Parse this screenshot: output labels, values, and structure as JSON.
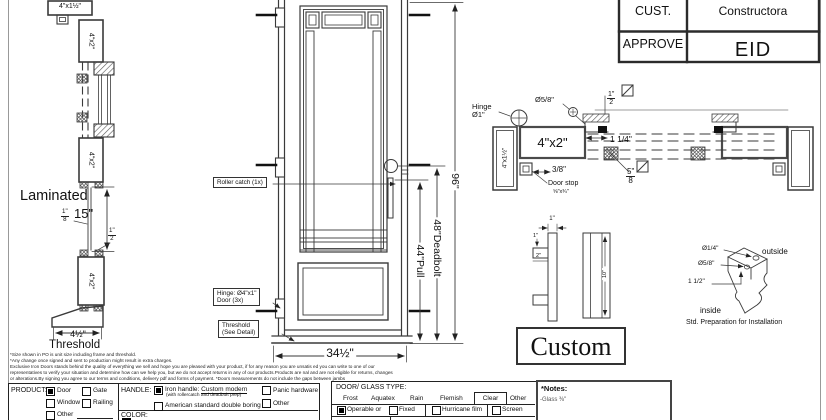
{
  "title_block": {
    "cust_label": "CUST.",
    "cust_value": "Constructora",
    "approve_label": "APPROVE",
    "approve_value": "EID"
  },
  "left_section": {
    "head_jamb": "4\"x1½\"",
    "top_rail": "4\"x2\"",
    "mid_rail": "4\"x2\"",
    "bottom_rail": "4\"x2\"",
    "laminated": "Laminated",
    "panel_thickness_num": "1\"",
    "panel_thickness_den": "8",
    "panel_height": "15\"",
    "offset_num": "1\"",
    "offset_den": "2",
    "threshold_width": "4½\"",
    "threshold_label": "Threshold"
  },
  "elevation": {
    "roller_catch": "Roller catch (1x)",
    "hinge_note_1": "Hinge: Ø4\"x1\"",
    "hinge_note_2": "Door (3x)",
    "threshold_note_1": "Threshold",
    "threshold_note_2": "(See Detail)",
    "width_dim": "34½\"",
    "pull_dim": "44\"Pull",
    "deadbolt_dim": "48\"Deadbolt",
    "height_dim": "96\""
  },
  "plan_section": {
    "hinge_label_1": "Hinge",
    "hinge_label_2": "Ø1\"",
    "pin_dia": "Ø5/8\"",
    "gap_num": "1\"",
    "gap_den": "2",
    "head_jamb": "4\"x2\"",
    "side_jamb": "4\"x1½\"",
    "stile_dim": "1 1/4\"",
    "stop_offset": "3/8\"",
    "door_stop_1": "Door stop",
    "door_stop_2": "⅝\"x¾\"",
    "glass_num": "5\"",
    "glass_den": "8"
  },
  "handle_detail": {
    "width_dim": "1\"",
    "stem_dim_1": "1\"",
    "stem_dim_2": "2\"",
    "length_dim": "10\"",
    "style_name": "Custom"
  },
  "prep_detail": {
    "hole_small": "Ø1/4\"",
    "hole_large": "Ø5/8\"",
    "spacing": "1 1/2\"",
    "outside": "outside",
    "inside": "inside",
    "caption": "Std. Preparation for Installation"
  },
  "fine_print": {
    "line1": "*Size shown in PO is unit size including frame and threshold.",
    "line2": "*Any change once signed and sent to production might result in extra charges.",
    "line3": "Exclusive Iron Doors stands behind the quality of everything we sell and hope you are pleased with your product, if for any reason you are unsatis  ed you can write to one of our",
    "line4": "representatives to verify your situation and determine how can we help you, but we do not accept returns in any of our products.Products are    nal and are not eligible for returns, changes",
    "line5": "or alterations.By signing you agree to our terms and conditions, delivery pdf and forms of payment. *Doors measurements do not include the gaps between jambs"
  },
  "form": {
    "product": {
      "label": "PRODUCT:",
      "door": "Door",
      "gate": "Gate",
      "window": "Window",
      "railing": "Railing",
      "other": "Other",
      "checked": {
        "door": true,
        "gate": false,
        "window": false,
        "railing": false,
        "other": false
      }
    },
    "handle": {
      "label": "HANDLE:",
      "iron_prefix": "Iron handle:",
      "iron_style": "Custom modern",
      "iron_sub": "(with rollercatch and deadbolt prep)",
      "american": "American standard double boring",
      "panic": "Panic hardware",
      "other": "Other",
      "checked": {
        "iron": true,
        "american": false,
        "panic": false,
        "other": false
      }
    },
    "color_label": "COLOR:",
    "glass": {
      "label": "DOOR/ GLASS TYPE:",
      "frost": "Frost",
      "aquatex": "Aquatex",
      "rain": "Rain",
      "flemish": "Flemish",
      "clear": "Clear",
      "other": "Other",
      "selected": "Clear"
    },
    "options_row": {
      "operable": "Operable  or",
      "fixed": "Fixed",
      "hurricane": "Hurricane film",
      "screen": "Screen",
      "checked": {
        "operable": true,
        "fixed": false,
        "hurricane": false,
        "screen": false
      }
    },
    "notes": {
      "label": "*Notes:",
      "glass_note": "-Glass ⅜\""
    }
  }
}
